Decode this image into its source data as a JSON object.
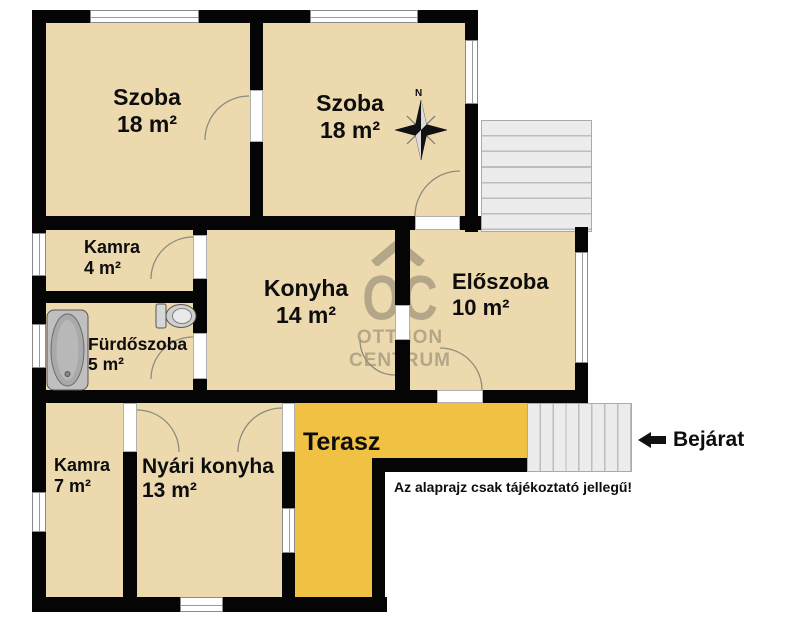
{
  "rooms": [
    {
      "id": "szoba-1",
      "name": "Szoba",
      "area": "18 m²"
    },
    {
      "id": "szoba-2",
      "name": "Szoba",
      "area": "18 m²"
    },
    {
      "id": "kamra-1",
      "name": "Kamra",
      "area": "4 m²"
    },
    {
      "id": "konyha",
      "name": "Konyha",
      "area": "14 m²"
    },
    {
      "id": "eloszoba",
      "name": "Előszoba",
      "area": "10 m²"
    },
    {
      "id": "furdoszoba",
      "name": "Fürdőszoba",
      "area": "5 m²"
    },
    {
      "id": "kamra-2",
      "name": "Kamra",
      "area": "7 m²"
    },
    {
      "id": "nyari-konyha",
      "name": "Nyári konyha",
      "area": "13 m²"
    },
    {
      "id": "terasz",
      "name": "Terasz",
      "area": ""
    }
  ],
  "labels": {
    "entrance": "Bejárat",
    "disclaimer": "Az alaprajz csak tájékoztató jellegű!",
    "compass_north": "N"
  },
  "watermark": {
    "monogram": "OC",
    "line1": "OTTHON",
    "line2": "CENTRUM"
  },
  "colors": {
    "room_fill": "#EDD9AE",
    "terrace_fill": "#F0C143",
    "wall": "#050505",
    "stairs_fill": "#ECECEC",
    "watermark": "#92886F"
  }
}
